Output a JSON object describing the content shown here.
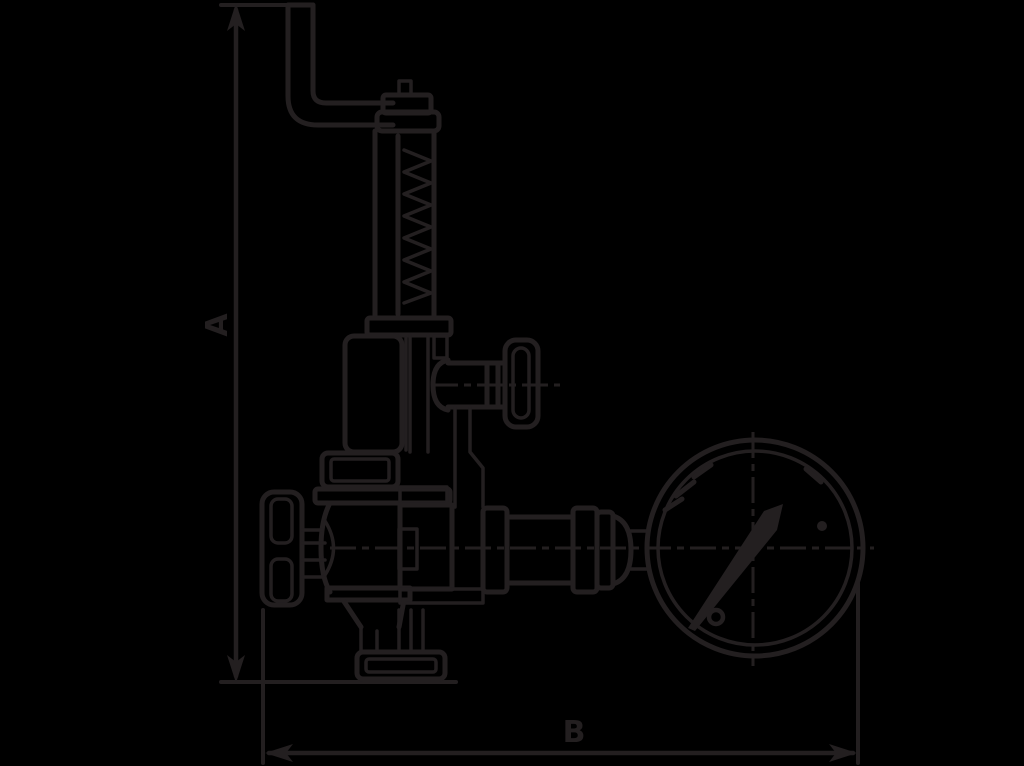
{
  "colors": {
    "background": "#000000",
    "line": "#231f20"
  },
  "dimensions": {
    "vertical_label": "A",
    "horizontal_label": "B"
  },
  "drawing": {
    "components": [
      "lift-lever",
      "spindle-cap",
      "spring-housing",
      "spring-coil",
      "bonnet",
      "test-branch",
      "test-knob",
      "packing-nut",
      "valve-body",
      "handwheel",
      "outlet-funnel",
      "outlet-flange",
      "union-fittings",
      "gauge-stem",
      "pressure-gauge",
      "gauge-needle",
      "gauge-dial-ticks",
      "gauge-screws"
    ]
  }
}
